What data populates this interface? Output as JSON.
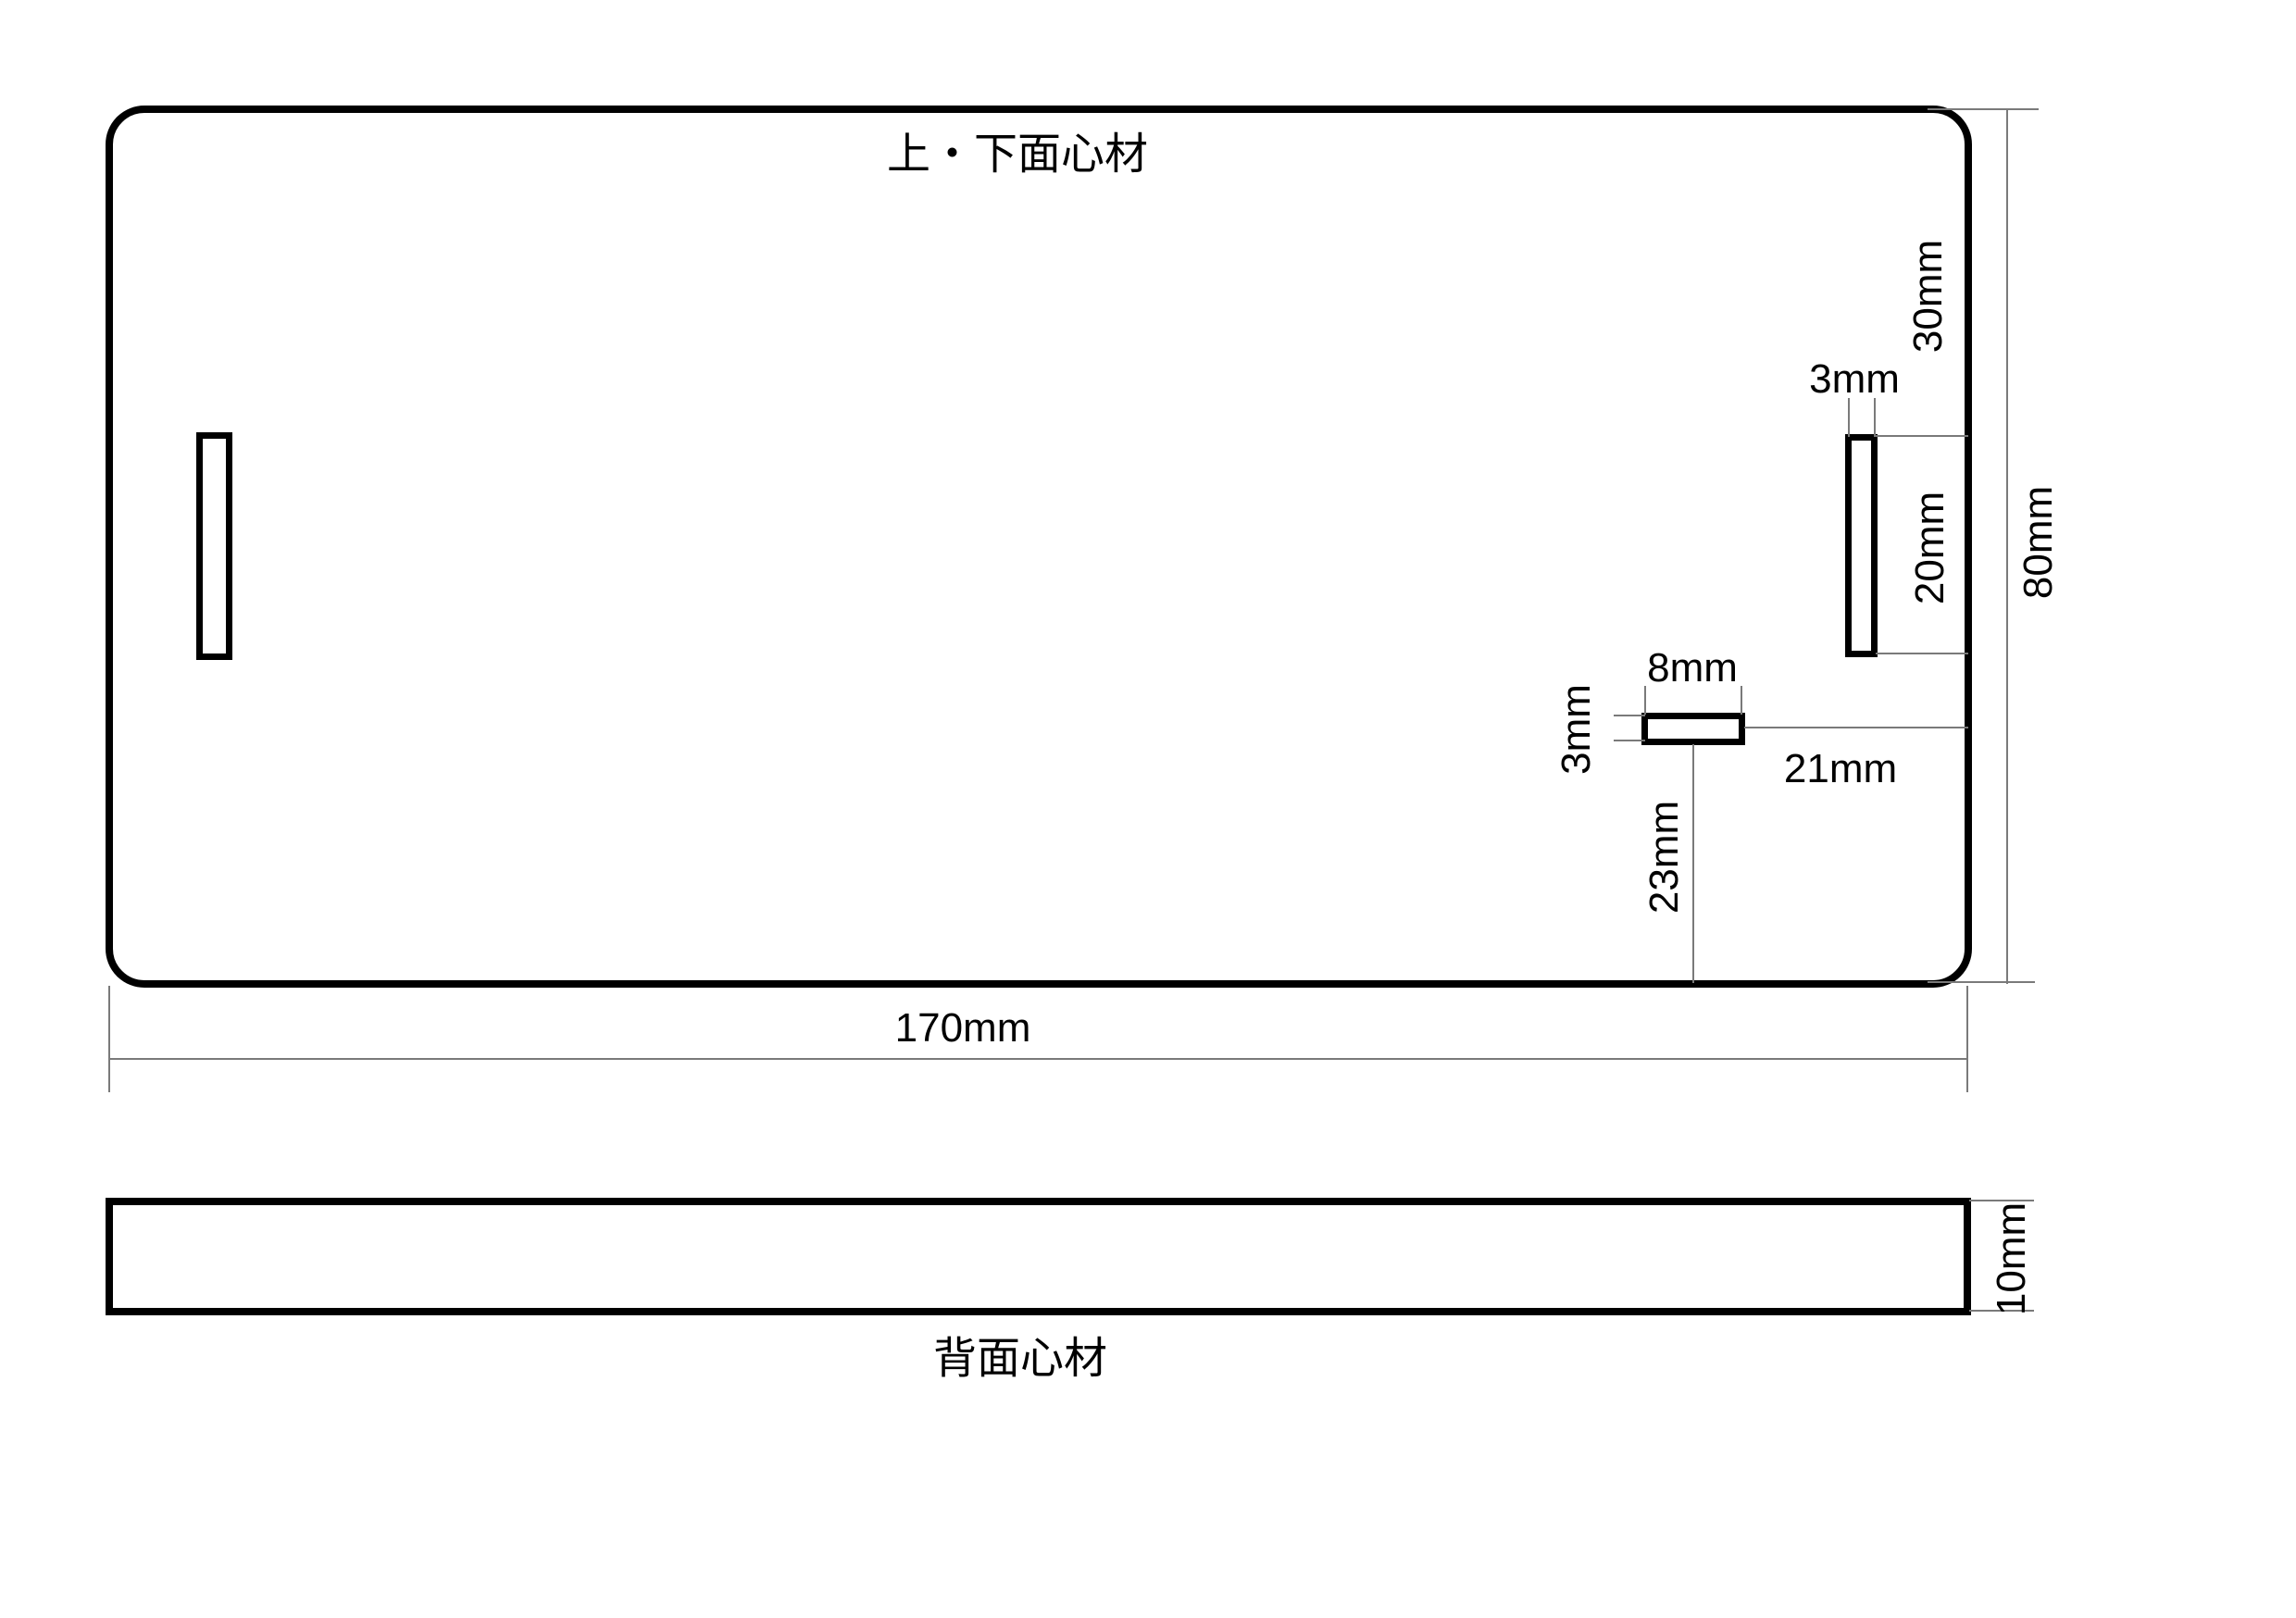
{
  "colors": {
    "background": "#ffffff",
    "outline": "#000000",
    "dim_line": "#7a7a7a",
    "text": "#000000"
  },
  "top_view": {
    "title": "上・下面心材",
    "dimensions": {
      "plate_width": "170mm",
      "plate_height": "80mm",
      "slot_top_offset": "30mm",
      "slot_length": "20mm",
      "slot_width": "3mm",
      "notch_width": "8mm",
      "notch_height": "3mm",
      "notch_right_offset": "21mm",
      "notch_bottom_offset": "23mm"
    }
  },
  "back_view": {
    "title": "背面心材",
    "dimensions": {
      "thickness": "10mm"
    }
  }
}
